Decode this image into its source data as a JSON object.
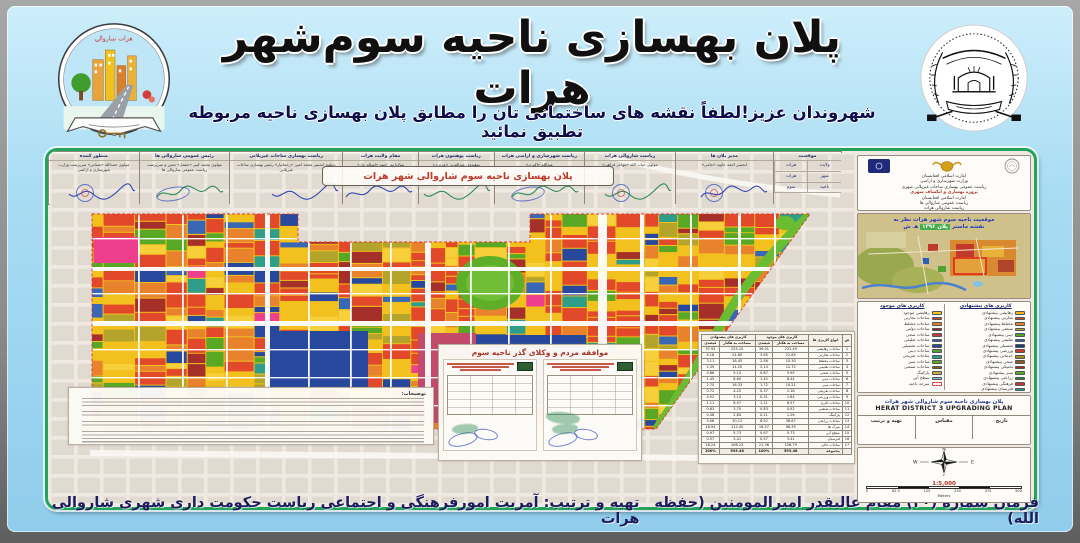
{
  "header": {
    "title": "پلان بهسازی ناحیه سوم‌شهر هرات",
    "subtitle": "شهروندان عزیز!لطفاً نقشه های ساختمانی تان را مطابق پلان بهسازی ناحیه مربوطه تطبیق نمائید",
    "left_logo_arc_text": "هرات ښاروالۍ"
  },
  "map": {
    "title_box": "پلان بهسازی ناحیه سوم شاروالی شهر هرات"
  },
  "sidebar": {
    "org_block": {
      "lines": [
        "امارت اسلامی افغانستان",
        "وزارت شهرسازی و اراضی",
        "ریاست عمومی بهسازی ساحات غیرپلانی شهری",
        "پروژه بهسازی و انکشاف شهری",
        "امارت اسلامی افغانستان",
        "ریاست عمومی شاروالی ها",
        "ریاست شاروالی هرات"
      ]
    },
    "inset": {
      "title_line1": "موقعیت ناحیه سوم شهر هرات نظر به",
      "title_line2_pre": "نقشه ماستر ",
      "title_line2_hl": "پلان ۱۳۹۶",
      "title_line2_post": " هـ ش"
    },
    "legend": {
      "proposed": {
        "title": "کاربری های پیشنهادی",
        "items": [
          {
            "label": "رهایشی پیشنهادی",
            "color": "#f2b21d"
          },
          {
            "label": "تجارتی پیشنهادی",
            "color": "#d9442a"
          },
          {
            "label": "مختلط پیشنهادی",
            "color": "#e07f2e"
          },
          {
            "label": "صنعتی پیشنهادی",
            "color": "#b0a02c"
          },
          {
            "label": "دینی پیشنهادی",
            "color": "#4fa32e"
          },
          {
            "label": "تعلیمی پیشنهادی",
            "color": "#2f5fae"
          },
          {
            "label": "تحصیلی پیشنهادی",
            "color": "#1f3d7a"
          },
          {
            "label": "ورزشی پیشنهادی",
            "color": "#cf3a2a"
          },
          {
            "label": "خدماتی پیشنهادی",
            "color": "#9c8f23"
          },
          {
            "label": "صحی پیشنهادی",
            "color": "#8a5a2b"
          },
          {
            "label": "تخنیکی پیشنهادی",
            "color": "#a32d25"
          },
          {
            "label": "سبز پیشنهادی",
            "color": "#58a826"
          },
          {
            "label": "زراعتی پیشنهادی",
            "color": "#2e7d32"
          },
          {
            "label": "فرهنگی پیشنهادی",
            "color": "#c63939"
          },
          {
            "label": "قبرستان پیشنهادی",
            "color": "#2e9d8a"
          }
        ]
      },
      "existing": {
        "title": "کاربری های موجود",
        "items": [
          {
            "label": "رهایشی موجود",
            "color": "#f2c11e"
          },
          {
            "label": "ساحات تجارتی",
            "color": "#d9442a"
          },
          {
            "label": "ساحات مختلط",
            "color": "#e07f2e"
          },
          {
            "label": "ساحات دولتی",
            "color": "#8e2a22"
          },
          {
            "label": "ساحات صحی",
            "color": "#c63939"
          },
          {
            "label": "ساحات تعلیمی",
            "color": "#2f5fae"
          },
          {
            "label": "ساحات تحصیلی",
            "color": "#27489c"
          },
          {
            "label": "ساحات دینی",
            "color": "#4fa32e"
          },
          {
            "label": "ساحات تفریحی",
            "color": "#2e9d8a"
          },
          {
            "label": "ساحات سبز",
            "color": "#58a826"
          },
          {
            "label": "ساحات صنعتی",
            "color": "#8a5a2b"
          },
          {
            "label": "پارکینگ",
            "color": "#caa84e"
          },
          {
            "label": "سطح آبی",
            "color": "#7ec3e8"
          },
          {
            "label": "سرحد ناحیه",
            "color": "#ffffff"
          }
        ]
      }
    },
    "titleblock": {
      "fa": "پلان بهسازی ناحیه سوم شاروالی شهر هرات",
      "en": "HERAT DISTRICT 3 UPGRADING PLAN",
      "cells": [
        "تاریخ",
        "مقیاس",
        "تهیه و ترتیب"
      ]
    },
    "compass": {
      "n": "N",
      "s": "S",
      "e": "E",
      "w": "W",
      "scale_text": "1:5,000",
      "ticks": [
        "0",
        "62.5",
        "125",
        "250",
        "375",
        "500"
      ],
      "meters_label": "Meters"
    }
  },
  "stats_table": {
    "headers": {
      "index": "ش",
      "type": "انواع کاربری ها",
      "existing": "کاربری های موجود",
      "proposed": "کاربری های پیشنهادی",
      "area": "مساحت به هکتار",
      "percent": "فیصدی"
    },
    "rows": [
      {
        "cat": "ساحات رهایشی",
        "e_ha": "231.49",
        "e_pc": "39.01",
        "p_ha": "225.10",
        "p_pc": "37.93"
      },
      {
        "cat": "ساحات تجارتی",
        "e_ha": "21.65",
        "e_pc": "3.65",
        "p_ha": "24.80",
        "p_pc": "4.18"
      },
      {
        "cat": "ساحات مختلط",
        "e_ha": "15.30",
        "e_pc": "2.58",
        "p_ha": "18.45",
        "p_pc": "3.11"
      },
      {
        "cat": "ساحات تعلیمی",
        "e_ha": "12.72",
        "e_pc": "2.14",
        "p_ha": "14.20",
        "p_pc": "2.39"
      },
      {
        "cat": "ساحات صحی",
        "e_ha": "3.95",
        "e_pc": "0.67",
        "p_ha": "5.10",
        "p_pc": "0.86"
      },
      {
        "cat": "ساحات دینی",
        "e_ha": "8.44",
        "e_pc": "1.42",
        "p_ha": "8.60",
        "p_pc": "1.45"
      },
      {
        "cat": "ساحات سبز",
        "e_ha": "10.21",
        "e_pc": "1.72",
        "p_ha": "16.33",
        "p_pc": "2.75"
      },
      {
        "cat": "ساحات تفریحی",
        "e_ha": "2.18",
        "e_pc": "0.37",
        "p_ha": "4.25",
        "p_pc": "0.72"
      },
      {
        "cat": "ساحات ورزشی",
        "e_ha": "1.84",
        "e_pc": "0.31",
        "p_ha": "3.10",
        "p_pc": "0.52"
      },
      {
        "cat": "ساحات اداری",
        "e_ha": "6.57",
        "e_pc": "1.11",
        "p_ha": "6.57",
        "p_pc": "1.11"
      },
      {
        "cat": "ساحات صنعتی",
        "e_ha": "4.92",
        "e_pc": "0.83",
        "p_ha": "3.75",
        "p_pc": "0.63"
      },
      {
        "cat": "پارکینگ",
        "e_ha": "1.26",
        "e_pc": "0.21",
        "p_ha": "2.84",
        "p_pc": "0.48"
      },
      {
        "cat": "ساحات زراعتی",
        "e_ha": "38.67",
        "e_pc": "6.52",
        "p_ha": "30.12",
        "p_pc": "5.08"
      },
      {
        "cat": "سرک ها",
        "e_ha": "98.35",
        "e_pc": "16.57",
        "p_ha": "112.40",
        "p_pc": "18.94"
      },
      {
        "cat": "سطح آبی",
        "e_ha": "5.73",
        "e_pc": "0.97",
        "p_ha": "5.73",
        "p_pc": "0.97"
      },
      {
        "cat": "قبرستان",
        "e_ha": "3.41",
        "e_pc": "0.57",
        "p_ha": "3.41",
        "p_pc": "0.57"
      },
      {
        "cat": "ساحات خالی",
        "e_ha": "126.79",
        "e_pc": "21.36",
        "p_ha": "108.23",
        "p_pc": "18.24"
      }
    ],
    "total": {
      "cat": "مجموعه",
      "e_ha": "593.48",
      "e_pc": "100%",
      "p_ha": "593.48",
      "p_pc": "100%"
    }
  },
  "agreement": {
    "title": "موافقه مردم و وکلای گذر ناحیه سوم"
  },
  "notes": {
    "title": "توضیحات:",
    "paragraph_lines": [
      3,
      2,
      2,
      4
    ]
  },
  "signatures": {
    "location": {
      "title": "موقعیت",
      "rows": [
        [
          "ولایت",
          "هرات"
        ],
        [
          "شهر",
          "هرات"
        ],
        [
          "ناحیه",
          "سوم"
        ]
      ]
    },
    "columns": [
      {
        "title": "مدیر پلان ها",
        "name": "انجینیر احمد جاوید «جامی»",
        "ink": "#3347b0",
        "stamp": "round",
        "grow": 13
      },
      {
        "title": "ریاست شاروالی هرات",
        "name": "مولوی حیات الله «مهاجر فراهی»",
        "ink": "#2e8b57",
        "stamp": "round",
        "grow": 12
      },
      {
        "title": "ریاست شهرسازی و اراضی هرات",
        "name": "عبدالله «اکبری»",
        "ink": "#2e8b57",
        "stamp": "ellipse",
        "grow": 12
      },
      {
        "title": "ریاست پوهنتون هرات",
        "name": "پوهندوی عبدالعزیز «عزیزی»",
        "ink": "#2e8b57",
        "stamp": "none",
        "grow": 10
      },
      {
        "title": "مقام ولایت هرات",
        "name": "مولانا نور احمد «اسلام جار»",
        "ink": "#3347b0",
        "stamp": "none",
        "grow": 10
      },
      {
        "title": "ریاست بهسازی ساحات غیرپلانی",
        "name": "دیپلوم انجینیر محمد امین «رحمانیار» رئیس بهسازی ساحات غیرپلانی",
        "ink": "#3347b0",
        "stamp": "none",
        "grow": 15
      },
      {
        "title": "رئیس عمومی شاروالی ها",
        "name": "مولوی محمد کبیر «حقمل» معین و سرپرست ریاست عمومی شاروالی ها",
        "ink": "#2e8b57",
        "stamp": "ellipse",
        "grow": 12
      },
      {
        "title": "منظور کننده",
        "name": "مولوی حمدالله «نعمانی» سرپرست وزارت شهرسازی و اراضی",
        "ink": "#3347b0",
        "stamp": "round",
        "grow": 12
      }
    ]
  },
  "footer": {
    "right": "فرمان شماره (۲۰) مقام عالیقدر امیرالمومنین (حفظه الله)",
    "left": "تهیه و ترتیب: آمریت امورفرهنگی و اجتماعی ریاست حکومت داری شهری شاروالی هرات"
  }
}
